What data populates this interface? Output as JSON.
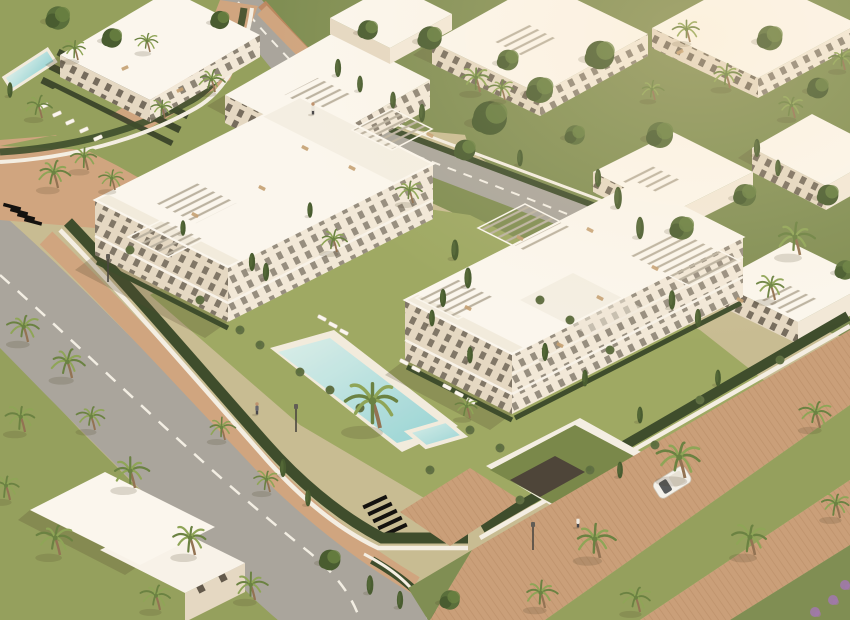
{
  "scene_label": "aerial-architectural-render-residential-complex",
  "colors": {
    "ground": "#c4b98f",
    "lawn": "#8d9b55",
    "lawnBright": "#97a45c",
    "lawnDark": "#76874a",
    "hedge": "#2f4120",
    "hedgeRow": "#1f2b18",
    "bush": "#55663a",
    "treeGreen": "#4d6530",
    "treeDark": "#3a5124",
    "palmGreen": "#86a04f",
    "palmDark": "#5f7a38",
    "trunk": "#8a6a4a",
    "road": "#a3a099",
    "roadMark": "#f2efe7",
    "sidewalk": "#cda07a",
    "promenade": "#c69a74",
    "brickLine": "#a77a52",
    "brickWall": "#bd8058",
    "poolLight": "#d8efec",
    "poolDeep": "#8fd2d6",
    "poolDeck": "#f1ecdf",
    "wall": "#f4efe5",
    "white": "#f8f4ec",
    "roof": "#fbf8f1",
    "roofShade": "#efe8da",
    "facade": "#f1e9da",
    "facadeShade": "#e3d7c3",
    "window": "#564e42",
    "wood": "#c09a6b",
    "slat": "#b6ae9e",
    "greenRoof": "#6f8040",
    "ramp": "#3f382e",
    "car": "#f4f2ee",
    "glass": "#4a4f52",
    "shadow": "rgba(70,60,35,0.25)",
    "treeShadow": "rgba(60,50,30,0.18)",
    "skin": "#b98b66",
    "flower": "#9b6fae",
    "sunGlow": "rgba(255,226,180,0.28)"
  },
  "scene": {
    "palms": [
      [
        380,
        428,
        3.0
      ],
      [
        413,
        203,
        1.4
      ],
      [
        337,
        252,
        1.4
      ],
      [
        480,
        92,
        1.6
      ],
      [
        505,
        100,
        1.3
      ],
      [
        58,
        188,
        1.7
      ],
      [
        88,
        170,
        1.5
      ],
      [
        115,
        190,
        1.3
      ],
      [
        42,
        118,
        1.4
      ],
      [
        78,
        60,
        1.3
      ],
      [
        150,
        52,
        1.2
      ],
      [
        215,
        92,
        1.4
      ],
      [
        165,
        118,
        1.2
      ],
      [
        28,
        342,
        1.7
      ],
      [
        72,
        378,
        1.8
      ],
      [
        25,
        432,
        1.7
      ],
      [
        95,
        430,
        1.5
      ],
      [
        135,
        488,
        1.9
      ],
      [
        195,
        555,
        1.9
      ],
      [
        60,
        555,
        1.9
      ],
      [
        255,
        600,
        1.7
      ],
      [
        10,
        500,
        1.6
      ],
      [
        160,
        610,
        1.6
      ],
      [
        225,
        440,
        1.4
      ],
      [
        270,
        492,
        1.4
      ],
      [
        685,
        478,
        2.3
      ],
      [
        600,
        558,
        2.1
      ],
      [
        755,
        555,
        2.0
      ],
      [
        820,
        428,
        1.7
      ],
      [
        545,
        608,
        1.7
      ],
      [
        840,
        518,
        1.6
      ],
      [
        640,
        612,
        1.6
      ],
      [
        800,
        255,
        2.0
      ],
      [
        775,
        300,
        1.6
      ],
      [
        690,
        42,
        1.4
      ],
      [
        730,
        88,
        1.5
      ],
      [
        795,
        118,
        1.4
      ],
      [
        845,
        70,
        1.3
      ],
      [
        655,
        100,
        1.2
      ],
      [
        470,
        418,
        1.3
      ]
    ],
    "cypresses": [
      [
        252,
        262,
        1.3
      ],
      [
        266,
        272,
        1.3
      ],
      [
        183,
        228,
        1.1
      ],
      [
        455,
        250,
        1.5
      ],
      [
        468,
        278,
        1.5
      ],
      [
        443,
        298,
        1.3
      ],
      [
        432,
        318,
        1.2
      ],
      [
        545,
        352,
        1.3
      ],
      [
        585,
        378,
        1.2
      ],
      [
        640,
        415,
        1.2
      ],
      [
        672,
        300,
        1.4
      ],
      [
        698,
        318,
        1.3
      ],
      [
        338,
        68,
        1.3
      ],
      [
        360,
        84,
        1.2
      ],
      [
        393,
        100,
        1.2
      ],
      [
        422,
        113,
        1.3
      ],
      [
        618,
        198,
        1.6
      ],
      [
        640,
        228,
        1.6
      ],
      [
        598,
        178,
        1.3
      ],
      [
        520,
        158,
        1.2
      ],
      [
        757,
        148,
        1.3
      ],
      [
        778,
        168,
        1.2
      ],
      [
        283,
        468,
        1.3
      ],
      [
        308,
        498,
        1.2
      ],
      [
        718,
        378,
        1.2
      ],
      [
        470,
        355,
        1.2
      ],
      [
        310,
        210,
        1.1
      ],
      [
        620,
        470,
        1.2
      ],
      [
        10,
        90,
        1.1
      ],
      [
        370,
        585,
        1.4
      ],
      [
        400,
        600,
        1.3
      ]
    ],
    "trees": [
      [
        490,
        118,
        2.6
      ],
      [
        540,
        90,
        2.0
      ],
      [
        600,
        55,
        2.2
      ],
      [
        660,
        135,
        2.0
      ],
      [
        430,
        38,
        1.8
      ],
      [
        770,
        38,
        1.9
      ],
      [
        828,
        195,
        1.6
      ],
      [
        58,
        18,
        1.8
      ],
      [
        112,
        38,
        1.5
      ],
      [
        682,
        228,
        1.8
      ],
      [
        818,
        88,
        1.6
      ],
      [
        745,
        195,
        1.7
      ],
      [
        368,
        30,
        1.5
      ],
      [
        508,
        60,
        1.6
      ],
      [
        220,
        20,
        1.4
      ],
      [
        575,
        135,
        1.5
      ],
      [
        465,
        150,
        1.6
      ],
      [
        845,
        270,
        1.5
      ],
      [
        330,
        560,
        1.6
      ],
      [
        450,
        600,
        1.5
      ]
    ],
    "bushes": [
      [
        240,
        330,
        1
      ],
      [
        260,
        345,
        1
      ],
      [
        300,
        372,
        1
      ],
      [
        330,
        390,
        1
      ],
      [
        360,
        408,
        1
      ],
      [
        470,
        430,
        1
      ],
      [
        500,
        448,
        1
      ],
      [
        540,
        300,
        1
      ],
      [
        570,
        320,
        1
      ],
      [
        130,
        250,
        1
      ],
      [
        200,
        300,
        1
      ],
      [
        610,
        350,
        1
      ],
      [
        700,
        400,
        1
      ],
      [
        430,
        470,
        1
      ],
      [
        520,
        500,
        1
      ],
      [
        590,
        470,
        1
      ],
      [
        655,
        445,
        1
      ],
      [
        780,
        360,
        1
      ]
    ],
    "loungers": [
      [
        322,
        318,
        27
      ],
      [
        333,
        325,
        27
      ],
      [
        344,
        332,
        27
      ],
      [
        404,
        362,
        27
      ],
      [
        416,
        369,
        27
      ],
      [
        447,
        387,
        27
      ],
      [
        459,
        394,
        27
      ],
      [
        471,
        401,
        27
      ],
      [
        44,
        106,
        -24
      ],
      [
        57,
        114,
        -24
      ],
      [
        70,
        122,
        -24
      ],
      [
        84,
        130,
        -24
      ],
      [
        98,
        138,
        -24
      ]
    ],
    "furniture": [
      [
        305,
        148,
        27
      ],
      [
        262,
        188,
        27
      ],
      [
        195,
        215,
        27
      ],
      [
        352,
        168,
        27
      ],
      [
        520,
        238,
        27
      ],
      [
        600,
        298,
        27
      ],
      [
        468,
        308,
        27
      ],
      [
        655,
        268,
        27
      ],
      [
        560,
        345,
        27
      ],
      [
        125,
        68,
        -24
      ],
      [
        680,
        52,
        -27
      ],
      [
        740,
        300,
        27
      ],
      [
        180,
        90,
        -24
      ],
      [
        590,
        230,
        27
      ],
      [
        430,
        135,
        27
      ]
    ],
    "people": [
      [
        313,
        109,
        "#e8e4dc"
      ],
      [
        257,
        409,
        "#5a5c66"
      ],
      [
        578,
        522,
        "#f0ece4"
      ]
    ],
    "lamps": [
      [
        296,
        408
      ],
      [
        533,
        526
      ],
      [
        108,
        258
      ]
    ],
    "flowers": [
      [
        833,
        600
      ],
      [
        815,
        612
      ],
      [
        845,
        585
      ]
    ]
  }
}
